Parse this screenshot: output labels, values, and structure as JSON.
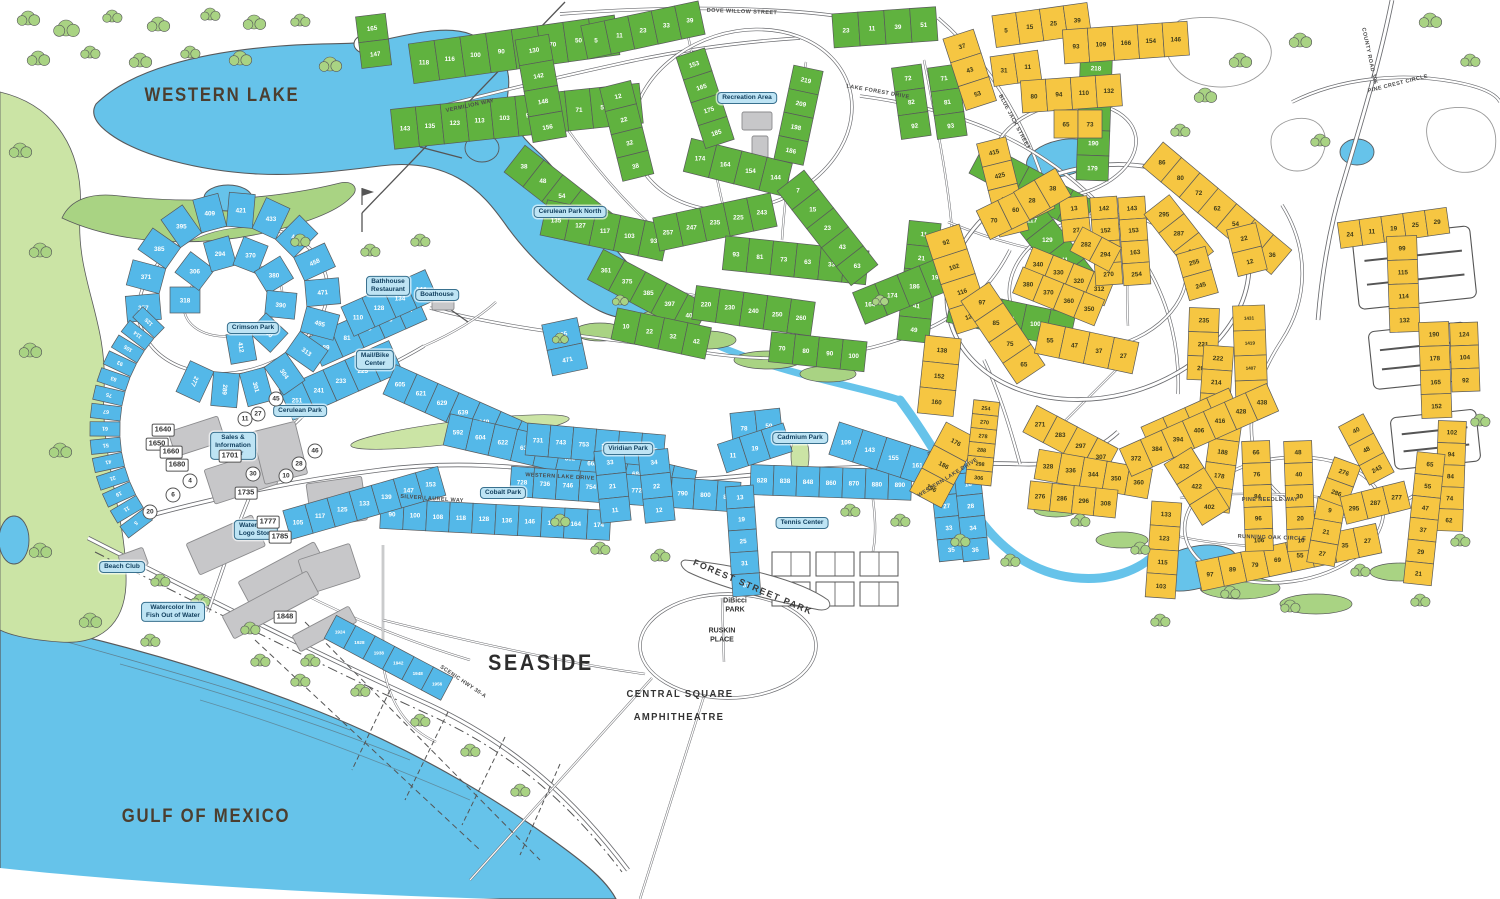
{
  "colors": {
    "water": "#66C3EA",
    "lot_blue": "#54B8E8",
    "lot_green": "#60B23F",
    "lot_yellow": "#F6C642",
    "veg": "#A9D383",
    "veg_light": "#CBE4A5",
    "ink": "#58595B",
    "road": "#6A6B6F",
    "building": "#C7C7C9",
    "building_stroke": "#8B8B8D",
    "label_brown": "#4C3E2F",
    "banner_bg": "#BEE4F4",
    "banner_border": "#39718F",
    "banner_text": "#0F3D5C",
    "lot_number_light": "#FFFFFF",
    "lot_number_dark": "#3E3A18"
  },
  "labels": {
    "western_lake": "WESTERN LAKE",
    "gulf_of_mexico": "GULF OF MEXICO",
    "seaside": "SEASIDE",
    "central_square": "CENTRAL SQUARE",
    "amphitheatre": "AMPHITHEATRE",
    "forest_street_park": "FOREST STREET PARK",
    "dibicci_park": "DiBicci\nPARK",
    "ruskin_place": "RUSKIN\nPLACE"
  },
  "banners": {
    "crimson_park": "Crimson Park",
    "cerulean_park": "Cerulean Park",
    "cerulean_park_north": "Cerulean Park North",
    "cobalt_park": "Cobalt Park",
    "viridian_park": "Viridian Park",
    "cadmium_park": "Cadmium Park",
    "tennis_center": "Tennis Center",
    "boathouse": "Boathouse",
    "bathhouse_restaurant": "Bathhouse\nRestaurant",
    "mail_bike_center": "Mail/Bike\nCenter",
    "sales_info_center": "Sales &\nInformation\nCenter",
    "watercolor_logo_store": "Watercolor\nLogo Store",
    "beach_club": "Beach Club",
    "watercolor_inn": "Watercolor Inn\nFish Out of Water",
    "recreation_area": "Recreation Area"
  },
  "streets": {
    "vermilion_way": "VERMILION WAY",
    "dove_willow_street": "DOVE WILLOW STREET",
    "blue_jack_street": "BLUE JACK STREET",
    "lake_forest_drive": "LAKE FOREST DRIVE",
    "western_lake_drive": "WESTERN LAKE DRIVE",
    "western_lake_drive_2": "WESTERN LAKE DRIVE",
    "silver_laurel_way": "SILVER LAUREL WAY",
    "pine_needle_way": "PINE NEEDLE WAY",
    "running_oak_circle": "RUNNING OAK CIRCLE",
    "county_road_395": "COUNTY ROAD 395",
    "scenic_hwy": "SCENIC HWY 30-A",
    "pine_crest_circle": "PINE CREST CIRCLE"
  },
  "building_numbers": [
    "1640",
    "1650",
    "1660",
    "1680",
    "1701",
    "1735",
    "1777",
    "1785",
    "1848"
  ],
  "circled_numbers": [
    "11",
    "27",
    "45",
    "4",
    "6",
    "20",
    "30",
    "10",
    "46",
    "28"
  ],
  "lots": {
    "g_a": [
      165,
      147
    ],
    "g_b": [
      118,
      116,
      100,
      90,
      82,
      70,
      50,
      48
    ],
    "g_c": [
      143,
      135,
      123,
      113,
      103,
      93,
      83,
      71,
      59,
      45
    ],
    "g_d": [
      130,
      142,
      148,
      156
    ],
    "g_e": [
      5,
      11,
      23,
      33,
      39
    ],
    "g_f": [
      12,
      22,
      32,
      38
    ],
    "g_g": [
      174,
      164,
      154,
      144
    ],
    "g_h": [
      38,
      48,
      54,
      72,
      82
    ],
    "g_i": [
      135,
      127,
      117,
      103,
      93
    ],
    "g_j": [
      361,
      375,
      385,
      397,
      409
    ],
    "g_k": [
      257,
      247,
      235,
      225,
      243
    ],
    "g_l": [
      93,
      81,
      73,
      63,
      33,
      23
    ],
    "g_m": [
      153,
      165,
      175,
      185
    ],
    "g_n": [
      219,
      209,
      198,
      186
    ],
    "g_o": [
      7,
      15,
      23,
      43,
      63
    ],
    "g_p": [
      23,
      11,
      39,
      51
    ],
    "g_q": [
      72,
      82,
      92
    ],
    "g_r": [
      71,
      81,
      93
    ],
    "g_s": [
      218,
      208,
      198,
      190,
      179
    ],
    "g_t": [
      113,
      121,
      131,
      137,
      147
    ],
    "g_u": [
      117,
      129,
      141,
      155
    ],
    "g_v": [
      11,
      21,
      31,
      41,
      49
    ],
    "g_w": [
      68,
      78,
      90,
      100,
      110
    ],
    "g_x": [
      164,
      174,
      186,
      198
    ],
    "g_y": [
      220,
      230,
      240,
      250,
      260
    ],
    "g_z": [
      10,
      22,
      32,
      42
    ],
    "g_z2": [
      70,
      80,
      90,
      100
    ],
    "b_a": [
      251,
      241,
      233,
      225,
      217
    ],
    "b_b": [
      495,
      471
    ],
    "b_c": [
      605,
      621,
      629,
      639,
      649,
      657,
      665,
      675,
      685,
      695,
      705
    ],
    "b_d": [
      592,
      604,
      622,
      632,
      642,
      652,
      662,
      672,
      684,
      694,
      704
    ],
    "b_e": [
      731,
      743,
      753,
      765,
      775,
      785
    ],
    "b_f": [
      728,
      736,
      746,
      754,
      764,
      772,
      782,
      790,
      800,
      810
    ],
    "b_g": [
      828,
      838,
      848,
      860,
      870,
      880,
      890
    ],
    "b_h": [
      90,
      100,
      108,
      118,
      128,
      136,
      146,
      154,
      164,
      174
    ],
    "b_i": [
      105,
      117,
      125,
      133,
      139,
      147,
      153
    ],
    "b_j": [
      33,
      21,
      11
    ],
    "b_k": [
      34,
      22,
      12
    ],
    "b_l": [
      78,
      59
    ],
    "b_m": [
      109,
      143,
      155,
      161,
      167
    ],
    "b_n": [
      11,
      19,
      29
    ],
    "b_o": [
      13,
      19,
      25,
      31,
      37
    ],
    "b_p": [
      9,
      17,
      27,
      33,
      35
    ],
    "b_q": [
      10,
      18,
      28,
      34,
      36
    ],
    "b_r": [
      1924,
      1928,
      1938,
      1942,
      1948,
      1956
    ],
    "b_s": [
      89,
      81,
      73,
      65,
      57
    ],
    "b_t": [
      110,
      128,
      134,
      144
    ],
    "arc_b1": [
      357,
      371,
      385,
      395,
      409,
      421,
      433,
      445,
      458,
      471,
      495,
      313,
      304,
      301,
      289,
      277
    ],
    "arc_b2": [
      318,
      306,
      294,
      370,
      380,
      390,
      400,
      412
    ],
    "arc_b3": [
      5,
      11,
      19,
      31,
      41,
      51,
      61,
      67,
      75,
      83,
      93,
      105,
      114,
      125
    ],
    "Y_a": [
      37,
      43,
      53
    ],
    "Y_b": [
      5,
      15,
      25,
      39
    ],
    "Y_c": [
      31,
      11
    ],
    "Y_d": [
      93,
      109,
      166,
      154,
      146
    ],
    "Y_e": [
      80,
      94,
      110,
      132
    ],
    "Y_f": [
      65,
      73
    ],
    "Y_g": [
      415,
      425,
      435,
      445
    ],
    "Y_h": [
      13,
      27
    ],
    "Y_i": [
      70,
      60,
      50
    ],
    "Y_j": [
      92,
      102,
      116,
      128
    ],
    "Y_k": [
      138,
      152,
      160
    ],
    "Y_l": [
      176,
      186,
      196
    ],
    "Y_m": [
      28,
      38
    ],
    "Y_n": [
      97,
      85,
      75,
      65
    ],
    "Y_o": [
      55,
      47,
      37,
      27
    ],
    "Y_p": [
      340,
      330,
      320,
      312
    ],
    "Y_q": [
      380,
      370,
      360,
      350
    ],
    "Y_r": [
      142,
      152,
      164,
      270
    ],
    "Y_s": [
      143,
      153,
      163,
      254
    ],
    "Y_t": [
      282,
      294
    ],
    "Y_u": [
      295,
      287,
      277
    ],
    "Y_v": [
      255,
      245
    ],
    "Y_w": [
      235,
      221,
      209
    ],
    "Y_x": [
      222,
      214,
      208,
      204
    ],
    "Y_y": [
      194,
      188,
      178,
      164
    ],
    "Y_z": [
      1431,
      1419,
      1407,
      1393
    ],
    "Y_A": [
      1302,
      1312,
      1322,
      1340
    ],
    "Y_B": [
      254,
      270,
      278,
      288,
      298,
      306
    ],
    "Y_C": [
      271,
      283,
      297,
      307
    ],
    "Y_D": [
      328,
      336,
      344,
      350,
      360
    ],
    "Y_E": [
      372,
      384,
      394,
      406,
      416,
      428,
      438
    ],
    "Y_F": [
      276,
      286,
      296,
      308
    ],
    "Y_G": [
      432,
      422,
      402
    ],
    "Y_H": [
      133,
      123,
      115,
      103
    ],
    "Y_I": [
      97,
      89,
      79,
      69,
      55,
      43,
      35,
      27
    ],
    "Y_J": [
      66,
      76,
      84,
      96,
      106
    ],
    "Y_K": [
      48,
      40,
      30,
      20,
      10
    ],
    "Y_L": [
      9,
      21,
      27
    ],
    "Y_M": [
      276,
      286
    ],
    "Y_N": [
      295,
      287,
      277
    ],
    "Y_O": [
      40,
      48,
      243
    ],
    "Y_P": [
      24,
      11,
      19,
      25,
      29
    ],
    "Y_Q": [
      86,
      80,
      72,
      62,
      54,
      44,
      36
    ],
    "Y_R": [
      22,
      12
    ],
    "Y_S": [
      102,
      94,
      84,
      74,
      62
    ],
    "Y_T": [
      65,
      55,
      47,
      37,
      29,
      21
    ],
    "Y_U": [
      99,
      115,
      114,
      132
    ],
    "Y_V": [
      190,
      178,
      165,
      152
    ],
    "Y_W": [
      124,
      104,
      92
    ]
  }
}
